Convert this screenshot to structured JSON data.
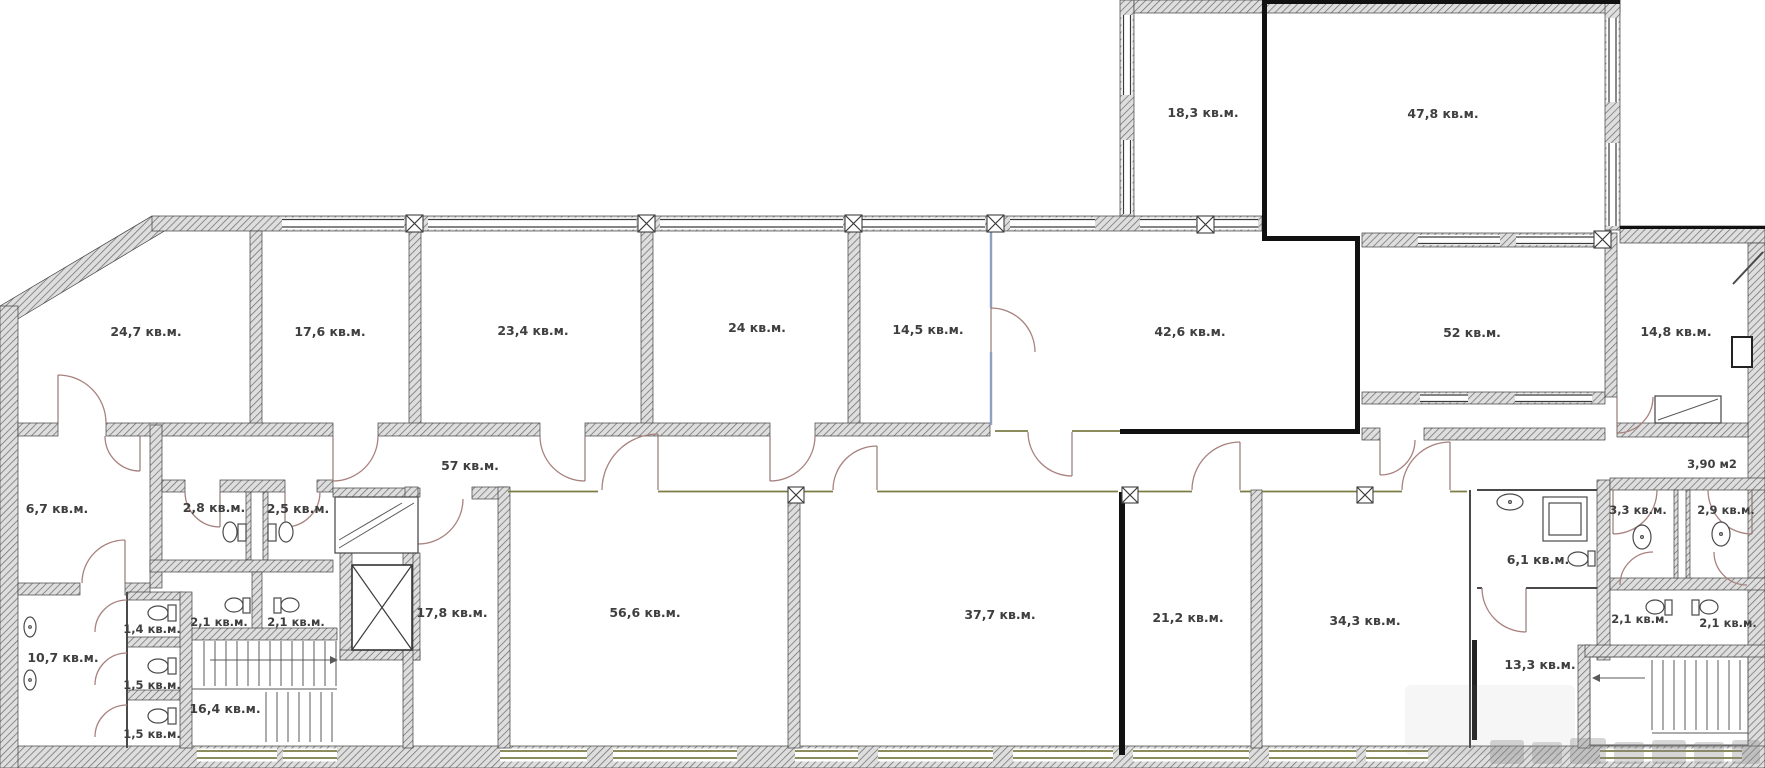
{
  "plan": {
    "type": "floor-plan",
    "area_unit": "кв.м.",
    "alt_area_unit": "м2"
  },
  "labels": [
    {
      "id": "room-18-3",
      "text": "18,3 кв.м."
    },
    {
      "id": "room-47-8",
      "text": "47,8 кв.м."
    },
    {
      "id": "room-24-7",
      "text": "24,7 кв.м."
    },
    {
      "id": "room-17-6",
      "text": "17,6 кв.м."
    },
    {
      "id": "room-23-4",
      "text": "23,4 кв.м."
    },
    {
      "id": "room-24",
      "text": "24 кв.м."
    },
    {
      "id": "room-14-5",
      "text": "14,5 кв.м."
    },
    {
      "id": "room-42-6",
      "text": "42,6 кв.м."
    },
    {
      "id": "room-52",
      "text": "52 кв.м."
    },
    {
      "id": "room-14-8",
      "text": "14,8 кв.м."
    },
    {
      "id": "corridor-57",
      "text": "57 кв.м."
    },
    {
      "id": "room-6-7",
      "text": "6,7 кв.м."
    },
    {
      "id": "wc-2-8",
      "text": "2,8 кв.м."
    },
    {
      "id": "wc-2-5",
      "text": "2,5 кв.м."
    },
    {
      "id": "wc-1-4",
      "text": "1,4 кв.м."
    },
    {
      "id": "wc-1-5-a",
      "text": "1,5 кв.м."
    },
    {
      "id": "wc-1-5-b",
      "text": "1,5 кв.м."
    },
    {
      "id": "wc-2-1-a",
      "text": "2,1 кв.м."
    },
    {
      "id": "wc-2-1-b",
      "text": "2,1 кв.м."
    },
    {
      "id": "room-10-7",
      "text": "10,7 кв.м."
    },
    {
      "id": "stair-16-4",
      "text": "16,4 кв.м."
    },
    {
      "id": "room-17-8",
      "text": "17,8 кв.м."
    },
    {
      "id": "room-56-6",
      "text": "56,6 кв.м."
    },
    {
      "id": "room-37-7",
      "text": "37,7 кв.м."
    },
    {
      "id": "room-21-2",
      "text": "21,2 кв.м."
    },
    {
      "id": "room-34-3",
      "text": "34,3 кв.м."
    },
    {
      "id": "room-6-1",
      "text": "6,1 кв.м."
    },
    {
      "id": "wc-3-3",
      "text": "3,3 кв.м."
    },
    {
      "id": "wc-2-9",
      "text": "2,9 кв.м."
    },
    {
      "id": "area-3-90",
      "text": "3,90 м2"
    },
    {
      "id": "wc-2-1-c",
      "text": "2,1 кв.м."
    },
    {
      "id": "wc-2-1-d",
      "text": "2,1 кв.м."
    },
    {
      "id": "room-13-3",
      "text": "13,3 кв.м."
    }
  ]
}
